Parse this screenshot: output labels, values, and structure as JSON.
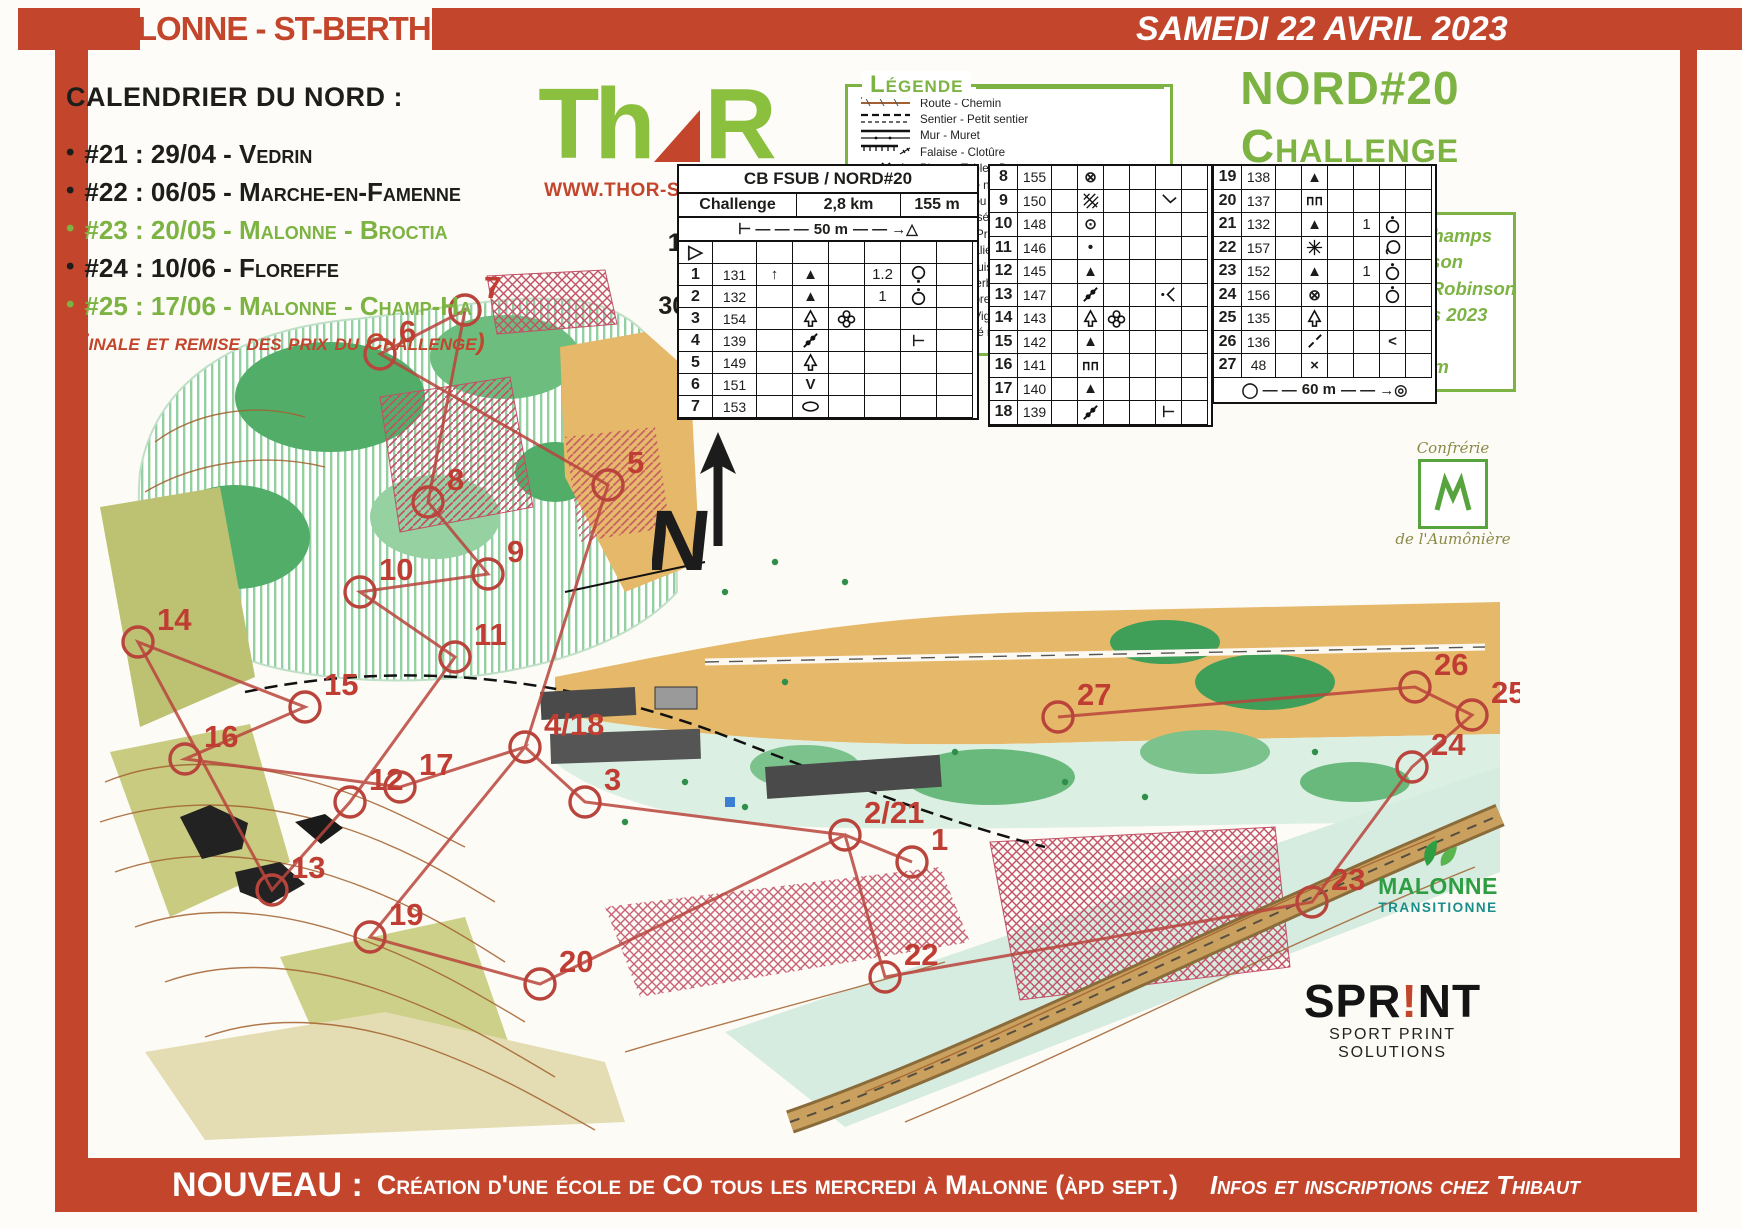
{
  "top_banner": {
    "title": "MALONNE - ST-BERTHUIN",
    "date": "SAMEDI 22 AVRIL 2023"
  },
  "calendar": {
    "title": "CALENDRIER DU NORD :",
    "items": [
      {
        "text": "#21 : 29/04 - Vedrin",
        "color": "black"
      },
      {
        "text": "#22 : 06/05 - Marche-en-Famenne",
        "color": "black"
      },
      {
        "text": "#23 : 20/05 - Malonne - Broctia",
        "color": "green"
      },
      {
        "text": "#24 : 10/06 - Floreffe",
        "color": "black"
      },
      {
        "text": "#25 : 17/06 - Malonne - Champ-Ha",
        "color": "green"
      }
    ],
    "note": "(Finale et remise des prix du Challenge)"
  },
  "thor": {
    "name_part1": "Th",
    "name_part2": "R",
    "website": "WWW.THOR-SPORT.BE"
  },
  "scale_block": {
    "line1": "1 cm (carte)",
    "equals": "=",
    "line2": "30 m (terrain)"
  },
  "legend": {
    "title": "Légende",
    "items": [
      {
        "symbol": "road",
        "label": "Route - Chemin"
      },
      {
        "symbol": "path",
        "label": "Sentier - Petit sentier"
      },
      {
        "symbol": "wall",
        "label": "Mur - Muret"
      },
      {
        "symbol": "cliff",
        "label": "Falaise - Clotûre"
      },
      {
        "symbol": "stone",
        "label": "Pierre - Table - Banc"
      },
      {
        "symbol": "contour",
        "label": "Courbes de niveau"
      },
      {
        "symbol": "knoll",
        "label": "Buttes - Trou - Trou d'eau"
      },
      {
        "symbol": "talus",
        "label": "Talus - Fossé"
      },
      {
        "symbol": "building",
        "label": "Bâtiment - Préau"
      },
      {
        "symbol": "bridge",
        "label": "Pont - Escalier"
      },
      {
        "symbol": "stump",
        "label": "Souche - Buisson - Arbres"
      },
      {
        "symbol": "zone",
        "label": "Zone : enherbée - découverte - plantée"
      },
      {
        "symbol": "forest",
        "label": "Forêt : propre - encombrée - infranchissable"
      },
      {
        "symbol": "cultures",
        "label": "Cultures - Vignes - Végétation au sol"
      },
      {
        "symbol": "private",
        "label": "Terrain privé ",
        "em": "INTERDIT !",
        "label2": " - Routes - Zone pavée"
      }
    ]
  },
  "event_title": {
    "line1": "NORD#20",
    "line2": "Challenge"
  },
  "map_info": {
    "lines": [
      "Carte : Malonne - Clinchamps",
      "Parcours : T. Robinson",
      "Carto : Thibaut & Lasko Robinson",
      "Réalisation : printemps 2023",
      "Echelle : 1/3000",
      "Equidistance : 2,5m"
    ]
  },
  "control_card": {
    "header_title": "CB FSUB / NORD#20",
    "course_name": "Challenge",
    "length": "2,8 km",
    "climb": "155 m",
    "start_scale_label": "50 m",
    "finish_scale_label": "60 m",
    "groups": [
      [
        {
          "n": "start",
          "code": "",
          "c": "",
          "d": "",
          "e": "",
          "f": "",
          "g": "",
          "h": ""
        },
        {
          "n": "1",
          "code": "131",
          "c": "arrow-up",
          "d": "hill",
          "e": "",
          "f": "1.2",
          "g": "circle-dot-below",
          "h": ""
        },
        {
          "n": "2",
          "code": "132",
          "c": "",
          "d": "hill",
          "e": "",
          "f": "1",
          "g": "circle-dot-above",
          "h": ""
        },
        {
          "n": "3",
          "code": "154",
          "c": "",
          "d": "tree",
          "e": "flower",
          "f": "",
          "g": "",
          "h": ""
        },
        {
          "n": "4",
          "code": "139",
          "c": "",
          "d": "fence",
          "e": "",
          "f": "",
          "g": "t-bar",
          "h": ""
        },
        {
          "n": "5",
          "code": "149",
          "c": "",
          "d": "tree",
          "e": "",
          "f": "",
          "g": "",
          "h": ""
        },
        {
          "n": "6",
          "code": "151",
          "c": "",
          "d": "v",
          "e": "",
          "f": "",
          "g": "",
          "h": ""
        },
        {
          "n": "7",
          "code": "153",
          "c": "",
          "d": "oval",
          "e": "",
          "f": "",
          "g": "",
          "h": ""
        }
      ],
      [
        {
          "n": "8",
          "code": "155",
          "c": "",
          "d": "circle-x",
          "e": "",
          "f": "",
          "g": "",
          "h": ""
        },
        {
          "n": "9",
          "code": "150",
          "c": "",
          "d": "thicket",
          "e": "",
          "f": "",
          "g": "elbow",
          "h": ""
        },
        {
          "n": "10",
          "code": "148",
          "c": "",
          "d": "circle-dot",
          "e": "",
          "f": "",
          "g": "",
          "h": ""
        },
        {
          "n": "11",
          "code": "146",
          "c": "",
          "d": "dot",
          "e": "",
          "f": "",
          "g": "",
          "h": ""
        },
        {
          "n": "12",
          "code": "145",
          "c": "",
          "d": "hill",
          "e": "",
          "f": "",
          "g": "",
          "h": ""
        },
        {
          "n": "13",
          "code": "147",
          "c": "",
          "d": "fence",
          "e": "",
          "f": "",
          "g": "junction",
          "h": ""
        },
        {
          "n": "14",
          "code": "143",
          "c": "",
          "d": "tree",
          "e": "flower",
          "f": "",
          "g": "",
          "h": ""
        },
        {
          "n": "15",
          "code": "142",
          "c": "",
          "d": "hill",
          "e": "",
          "f": "",
          "g": "",
          "h": ""
        },
        {
          "n": "16",
          "code": "141",
          "c": "",
          "d": "earthwall",
          "e": "",
          "f": "",
          "g": "",
          "h": ""
        },
        {
          "n": "17",
          "code": "140",
          "c": "",
          "d": "hill",
          "e": "",
          "f": "",
          "g": "",
          "h": ""
        },
        {
          "n": "18",
          "code": "139",
          "c": "",
          "d": "fence",
          "e": "",
          "f": "",
          "g": "t-bar",
          "h": ""
        }
      ],
      [
        {
          "n": "19",
          "code": "138",
          "c": "",
          "d": "hill",
          "e": "",
          "f": "",
          "g": "",
          "h": ""
        },
        {
          "n": "20",
          "code": "137",
          "c": "",
          "d": "earthwall",
          "e": "",
          "f": "",
          "g": "",
          "h": ""
        },
        {
          "n": "21",
          "code": "132",
          "c": "",
          "d": "hill",
          "e": "",
          "f": "1",
          "g": "circle-dot-above",
          "h": ""
        },
        {
          "n": "22",
          "code": "157",
          "c": "",
          "d": "star",
          "e": "",
          "f": "",
          "g": "circle-curl",
          "h": ""
        },
        {
          "n": "23",
          "code": "152",
          "c": "",
          "d": "hill",
          "e": "",
          "f": "1",
          "g": "circle-dot-above",
          "h": ""
        },
        {
          "n": "24",
          "code": "156",
          "c": "",
          "d": "circle-x",
          "e": "",
          "f": "",
          "g": "circle-dot-above",
          "h": ""
        },
        {
          "n": "25",
          "code": "135",
          "c": "",
          "d": "tree",
          "e": "",
          "f": "",
          "g": "",
          "h": ""
        },
        {
          "n": "26",
          "code": "136",
          "c": "",
          "d": "slash",
          "e": "",
          "f": "",
          "g": "lt",
          "h": ""
        },
        {
          "n": "27",
          "code": "48",
          "c": "",
          "d": "cross",
          "e": "",
          "f": "",
          "g": "",
          "h": ""
        }
      ]
    ]
  },
  "north_indicator": "N",
  "course": {
    "color": "#b9443c",
    "controls": [
      {
        "label": "1",
        "x": 827,
        "y": 600
      },
      {
        "label": "2/21",
        "x": 760,
        "y": 573
      },
      {
        "label": "3",
        "x": 500,
        "y": 540
      },
      {
        "label": "4/18",
        "x": 440,
        "y": 485
      },
      {
        "label": "5",
        "x": 523,
        "y": 223
      },
      {
        "label": "6",
        "x": 295,
        "y": 92
      },
      {
        "label": "7",
        "x": 380,
        "y": 48
      },
      {
        "label": "8",
        "x": 343,
        "y": 240
      },
      {
        "label": "9",
        "x": 403,
        "y": 312
      },
      {
        "label": "10",
        "x": 275,
        "y": 330
      },
      {
        "label": "11",
        "x": 370,
        "y": 395
      },
      {
        "label": "12",
        "x": 265,
        "y": 540
      },
      {
        "label": "13",
        "x": 187,
        "y": 628
      },
      {
        "label": "14",
        "x": 53,
        "y": 380
      },
      {
        "label": "15",
        "x": 220,
        "y": 445
      },
      {
        "label": "16",
        "x": 100,
        "y": 497
      },
      {
        "label": "17",
        "x": 315,
        "y": 525
      },
      {
        "label": "19",
        "x": 285,
        "y": 675
      },
      {
        "label": "20",
        "x": 455,
        "y": 722
      },
      {
        "label": "22",
        "x": 800,
        "y": 715
      },
      {
        "label": "23",
        "x": 1227,
        "y": 640
      },
      {
        "label": "24",
        "x": 1327,
        "y": 505
      },
      {
        "label": "25",
        "x": 1387,
        "y": 453
      },
      {
        "label": "26",
        "x": 1330,
        "y": 425
      },
      {
        "label": "27",
        "x": 973,
        "y": 455
      }
    ],
    "route": [
      "1",
      "2/21",
      "3",
      "4/18",
      "5",
      "6",
      "7",
      "8",
      "9",
      "10",
      "11",
      "12",
      "13",
      "14",
      "15",
      "16",
      "17",
      "4/18",
      "19",
      "20",
      "2/21",
      "22",
      "23",
      "24",
      "25",
      "26",
      "27"
    ]
  },
  "logos": {
    "confrerie": {
      "line1": "Confrérie",
      "line2": "de l'Aumônière"
    },
    "malonne_transitionne": {
      "line1": "MALONNE",
      "line2": "TRANSITIONNE"
    },
    "sprint": {
      "name_pre": "SPR",
      "bang": "!",
      "name_post": "NT",
      "tagline": "SPORT PRINT SOLUTIONS"
    }
  },
  "bottom_banner": {
    "lead": "NOUVEAU :",
    "body": "Création d'une école de CO tous les mercredi à Malonne (àpd sept.)",
    "tail": "Infos et inscriptions chez Thibaut"
  }
}
